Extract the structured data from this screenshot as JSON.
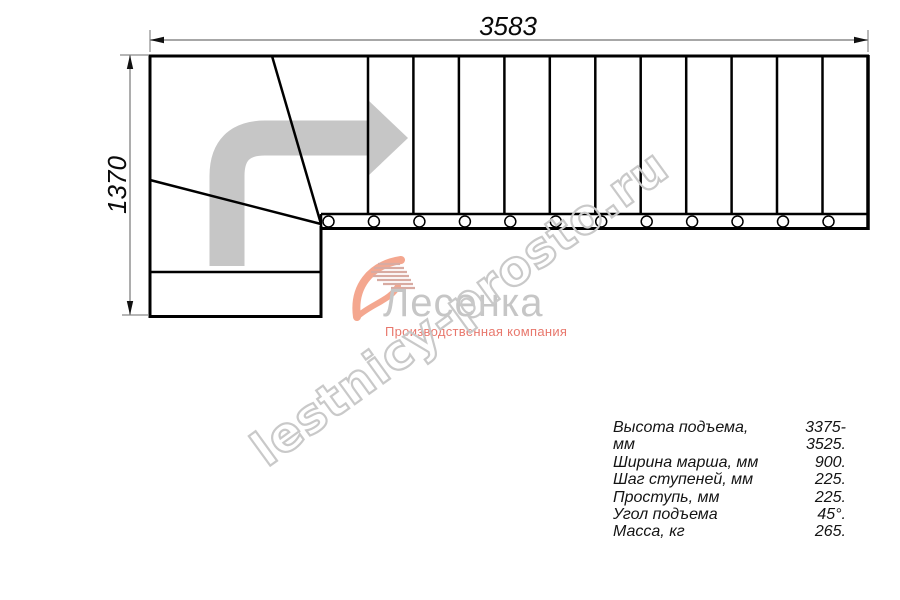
{
  "diagram": {
    "type": "staircase-plan-top-view",
    "top_dimension_mm": "3583",
    "left_dimension_mm": "1370",
    "straight_tread_count": 12,
    "winder_line_count": 2,
    "direction": "turn-right-then-straight"
  },
  "logo": {
    "brand": "Лесенка",
    "tagline": "Производственная компания"
  },
  "watermark": {
    "text": "lestnicy-prosto.ru"
  },
  "specs": {
    "rows": [
      {
        "label": "Высота подъема, мм",
        "value": "3375-3525."
      },
      {
        "label": "Ширина марша, мм",
        "value": "900."
      },
      {
        "label": "Шаг ступеней, мм",
        "value": "225."
      },
      {
        "label": "Проступь, мм",
        "value": "225."
      },
      {
        "label": "Угол подъема",
        "value": "45°."
      },
      {
        "label": "Масса, кг",
        "value": "265."
      }
    ]
  },
  "colors": {
    "line": "#000000",
    "dimension_line": "#8a8a8a",
    "direction_arrow": "#c6c6c6",
    "watermark_outline": "#c9c9c9",
    "brand_gray": "#c6c6c6",
    "tagline_red": "#e8786d",
    "swoosh_salmon": "#f4a78f",
    "swoosh_hatch": "#d8aba2"
  }
}
